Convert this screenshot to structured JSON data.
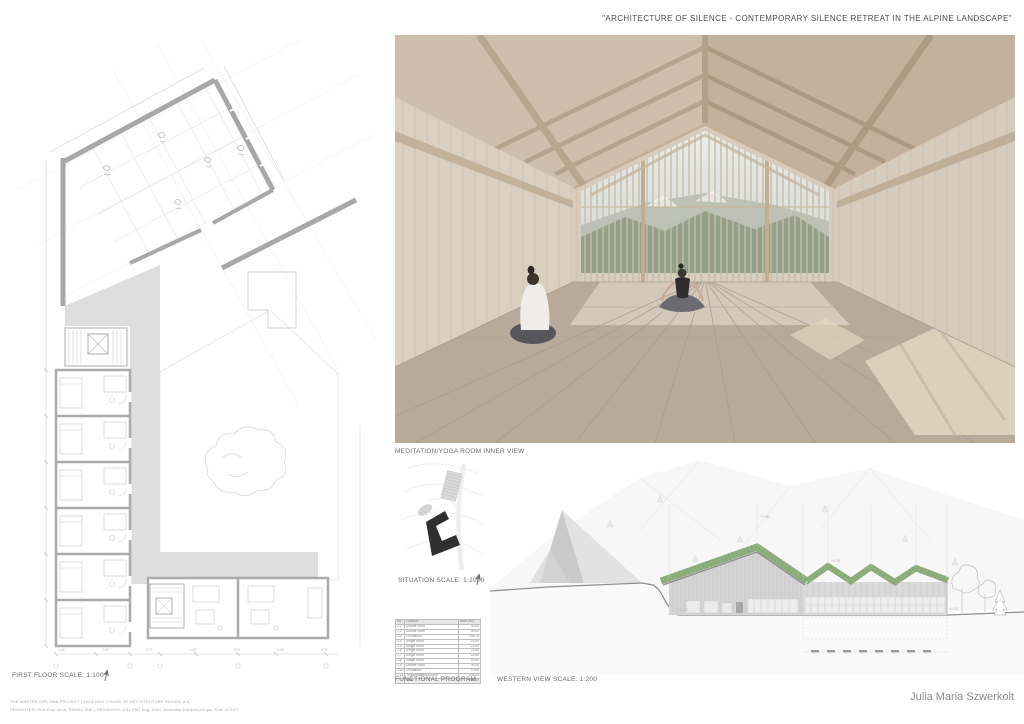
{
  "page": {
    "title": "\"ARCHITECTURE OF SILENCE - CONTEMPORARY SILENCE RETREAT IN THE ALPINE LANDSCAPE\""
  },
  "panels": {
    "first_floor": {
      "label": "FIRST FLOOR SCALE: 1:100",
      "dimensions": [
        "4.80",
        "2.00",
        "3.70",
        "4.00",
        "2.04",
        "2.00",
        "4.00"
      ]
    },
    "render": {
      "caption": "MEDITATION/YOGA ROOM INNER VIEW"
    },
    "situation": {
      "label": "SITUATION SCALE: 1:2000"
    },
    "functional_program": {
      "label": "FUNCTIONAL PROGRAM",
      "columns": [
        "No.",
        "Function",
        "Area [m2]"
      ],
      "rows": [
        {
          "no": "1.1",
          "function": "Double room",
          "area": "30.00"
        },
        {
          "no": "1.2",
          "function": "Double room",
          "area": "30.00"
        },
        {
          "no": "1.3",
          "function": "Circulation",
          "area": "148.70"
        },
        {
          "no": "1.4",
          "function": "Single room",
          "area": "22.50"
        },
        {
          "no": "1.5",
          "function": "Single room",
          "area": "22.50"
        },
        {
          "no": "1.6",
          "function": "Single room",
          "area": "22.50"
        },
        {
          "no": "1.7",
          "function": "Single room",
          "area": "22.50"
        },
        {
          "no": "1.8",
          "function": "Single room",
          "area": "22.50"
        },
        {
          "no": "1.9",
          "function": "Double room",
          "area": "30.00"
        },
        {
          "no": "1.10",
          "function": "Circulation",
          "area": "70.00"
        },
        {
          "no": "1.11",
          "function": "Yoga/meditation room",
          "area": "238.00"
        }
      ],
      "total_label": "Total",
      "total_value": "659.20"
    },
    "western_view": {
      "label": "WESTERN VIEW SCALE: 1:200",
      "levels": {
        "peak": "+7.45",
        "saw": "+4.95",
        "ground_left": "+0.00",
        "ground_right": "+0.00"
      }
    }
  },
  "footer": {
    "author": "Julia Maria Szwerkolt",
    "line1": "THE MASTER DIPLOMA PROJECT | 2023/2024 | CHAIR OF ARCHITECTURE DESIGN A-6",
    "line2": "PROMOTER: PhD Eng. Arch. PAWEL ZUK | REVIEWER: DSc PhD Eng. Arch. Dominika Kalwara-Klupa, Prof. of ZUT"
  },
  "colors": {
    "roof_green": "#8fb07c",
    "plan_gray": "#dedede",
    "wall_gray": "#d4d4d4",
    "footprint_black": "#2f2f2f",
    "render_beige": "#d6cbbc",
    "text_gray": "#4a4a4a"
  }
}
